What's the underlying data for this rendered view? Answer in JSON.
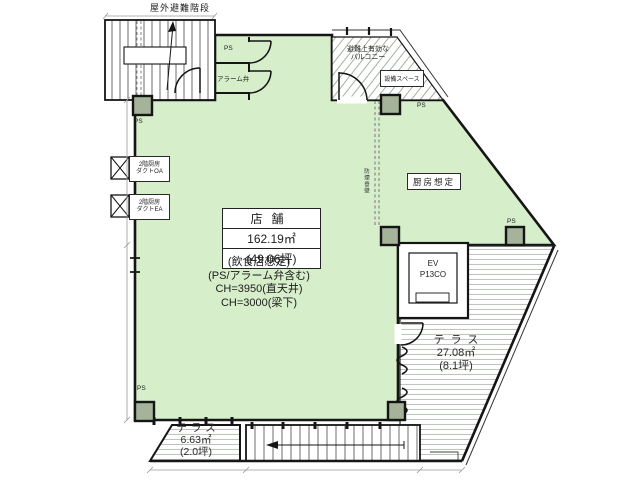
{
  "colors": {
    "floor_green": "#d7eecb",
    "column_fill": "#a4b39a",
    "wall": "#151515",
    "stripe_grey": "#b5bab3",
    "hatch_grey": "#9aa89a",
    "dim_grey": "#9a9a9a"
  },
  "stair": {
    "label": "屋外避難階段"
  },
  "rooms": {
    "ps_room": "PS",
    "alarm_valve": "アラーム弁",
    "balcony_line1": "避難上有効な",
    "balcony_line2": "バルコニー",
    "equipment_space": "設備スペース",
    "kitchen": "厨房想定",
    "smoke_wall": "防煙垂壁"
  },
  "ps_marks": {
    "top_left": "PS",
    "balcony": "PS",
    "right": "PS",
    "bottom_left": "PS"
  },
  "store": {
    "name": "店舗",
    "area_m2": "162.19㎡",
    "area_tsubo": "(49.06坪)",
    "note1": "(飲食店想定)",
    "note2": "(PS/アラーム弁含む)",
    "note3": "CH=3950(直天井)",
    "note4": "CH=3000(梁下)"
  },
  "elevator": {
    "name": "EV",
    "model": "P13CO"
  },
  "terraces": {
    "right": {
      "name": "テラス",
      "area": "27.08㎡",
      "tsubo": "(8.1坪)"
    },
    "bottom": {
      "name": "テラス",
      "area": "6.63㎡",
      "tsubo": "(2.0坪)"
    }
  },
  "ducts": {
    "oa": {
      "line1": "2階厨房",
      "line2": "ダクトOA"
    },
    "ea": {
      "line1": "2階厨房",
      "line2": "ダクトEA"
    }
  }
}
